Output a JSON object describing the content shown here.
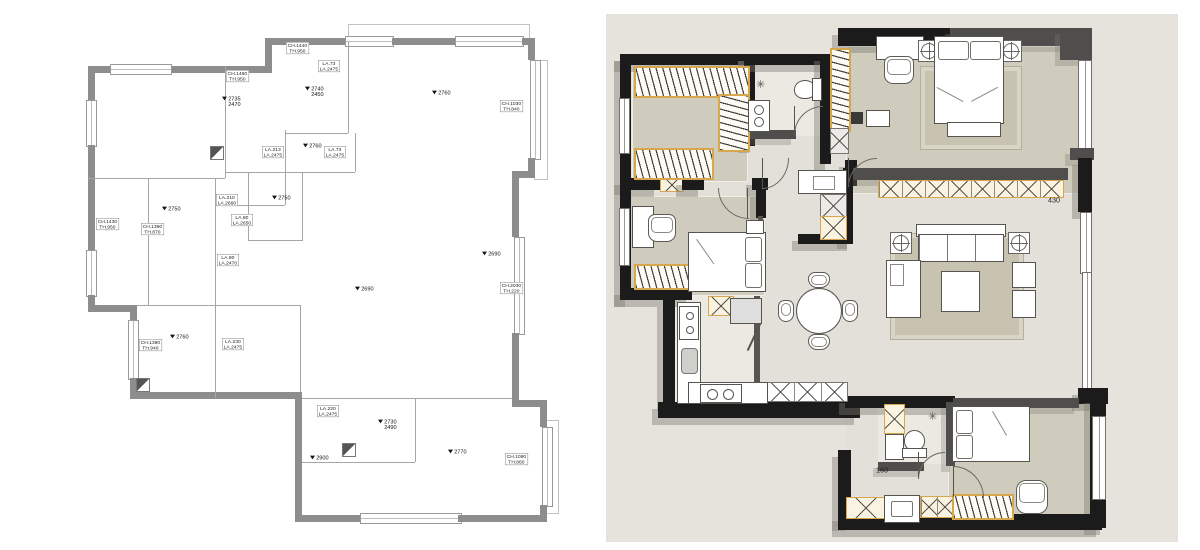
{
  "left_plan": {
    "elevation_labels": [
      {
        "x": 222,
        "y": 96,
        "lines": [
          "2735",
          "2470"
        ]
      },
      {
        "x": 305,
        "y": 86,
        "lines": [
          "2740",
          "2450"
        ]
      },
      {
        "x": 432,
        "y": 90,
        "lines": [
          "2760"
        ]
      },
      {
        "x": 303,
        "y": 143,
        "lines": [
          "2760"
        ]
      },
      {
        "x": 272,
        "y": 195,
        "lines": [
          "2750"
        ]
      },
      {
        "x": 162,
        "y": 206,
        "lines": [
          "2750"
        ]
      },
      {
        "x": 170,
        "y": 334,
        "lines": [
          "2760"
        ]
      },
      {
        "x": 355,
        "y": 286,
        "lines": [
          "2690"
        ]
      },
      {
        "x": 482,
        "y": 251,
        "lines": [
          "2690"
        ]
      },
      {
        "x": 378,
        "y": 419,
        "lines": [
          "2730",
          "2490"
        ]
      },
      {
        "x": 310,
        "y": 455,
        "lines": [
          "2900"
        ]
      },
      {
        "x": 448,
        "y": 449,
        "lines": [
          "2770"
        ]
      }
    ],
    "window_labels": [
      {
        "x": 286,
        "y": 42,
        "lines": [
          "CH.1440",
          "TH.950"
        ]
      },
      {
        "x": 226,
        "y": 70,
        "lines": [
          "CH.1460",
          "TH.950"
        ]
      },
      {
        "x": 318,
        "y": 60,
        "lines": [
          "LA.73",
          "LA.2475"
        ]
      },
      {
        "x": 262,
        "y": 146,
        "lines": [
          "LA.213",
          "LA.2475"
        ]
      },
      {
        "x": 324,
        "y": 146,
        "lines": [
          "LA.73",
          "LA.2475"
        ]
      },
      {
        "x": 96,
        "y": 218,
        "lines": [
          "CH.1430",
          "TH.950"
        ]
      },
      {
        "x": 141,
        "y": 223,
        "lines": [
          "CH.1390",
          "TH.870"
        ]
      },
      {
        "x": 216,
        "y": 194,
        "lines": [
          "LA.210",
          "LA.2660"
        ]
      },
      {
        "x": 231,
        "y": 214,
        "lines": [
          "LA.80",
          "LA.2650"
        ]
      },
      {
        "x": 217,
        "y": 254,
        "lines": [
          "LA.80",
          "LA.2470"
        ]
      },
      {
        "x": 500,
        "y": 100,
        "lines": [
          "CH.1030",
          "TH.840"
        ]
      },
      {
        "x": 500,
        "y": 282,
        "lines": [
          "CH.2030",
          "TH.220"
        ]
      },
      {
        "x": 139,
        "y": 339,
        "lines": [
          "CH.1390",
          "TH.940"
        ]
      },
      {
        "x": 222,
        "y": 338,
        "lines": [
          "LA.230",
          "LA.2475"
        ]
      },
      {
        "x": 317,
        "y": 405,
        "lines": [
          "LA.220",
          "LA.2475"
        ]
      },
      {
        "x": 505,
        "y": 453,
        "lines": [
          "CH.1090",
          "TH.860"
        ]
      }
    ]
  },
  "right_plan": {
    "annotations": [
      {
        "x": 1048,
        "y": 196,
        "text": "430"
      },
      {
        "x": 876,
        "y": 466,
        "text": "160"
      }
    ]
  },
  "colors": {
    "wall_gray": "#8d8d8d",
    "wall_black": "#1b1b1b",
    "wall_dark": "#4f4e4c",
    "panel_bg": "#e6e3dc",
    "floor_beige": "#cfcbbd",
    "floor_light": "#e3e0da",
    "rug": "#c7c3b0",
    "cabinet_orange": "#d8a64c",
    "shadow": "rgba(125,122,113,0.42)",
    "shadow_light": "rgba(125,122,113,0.30)"
  }
}
